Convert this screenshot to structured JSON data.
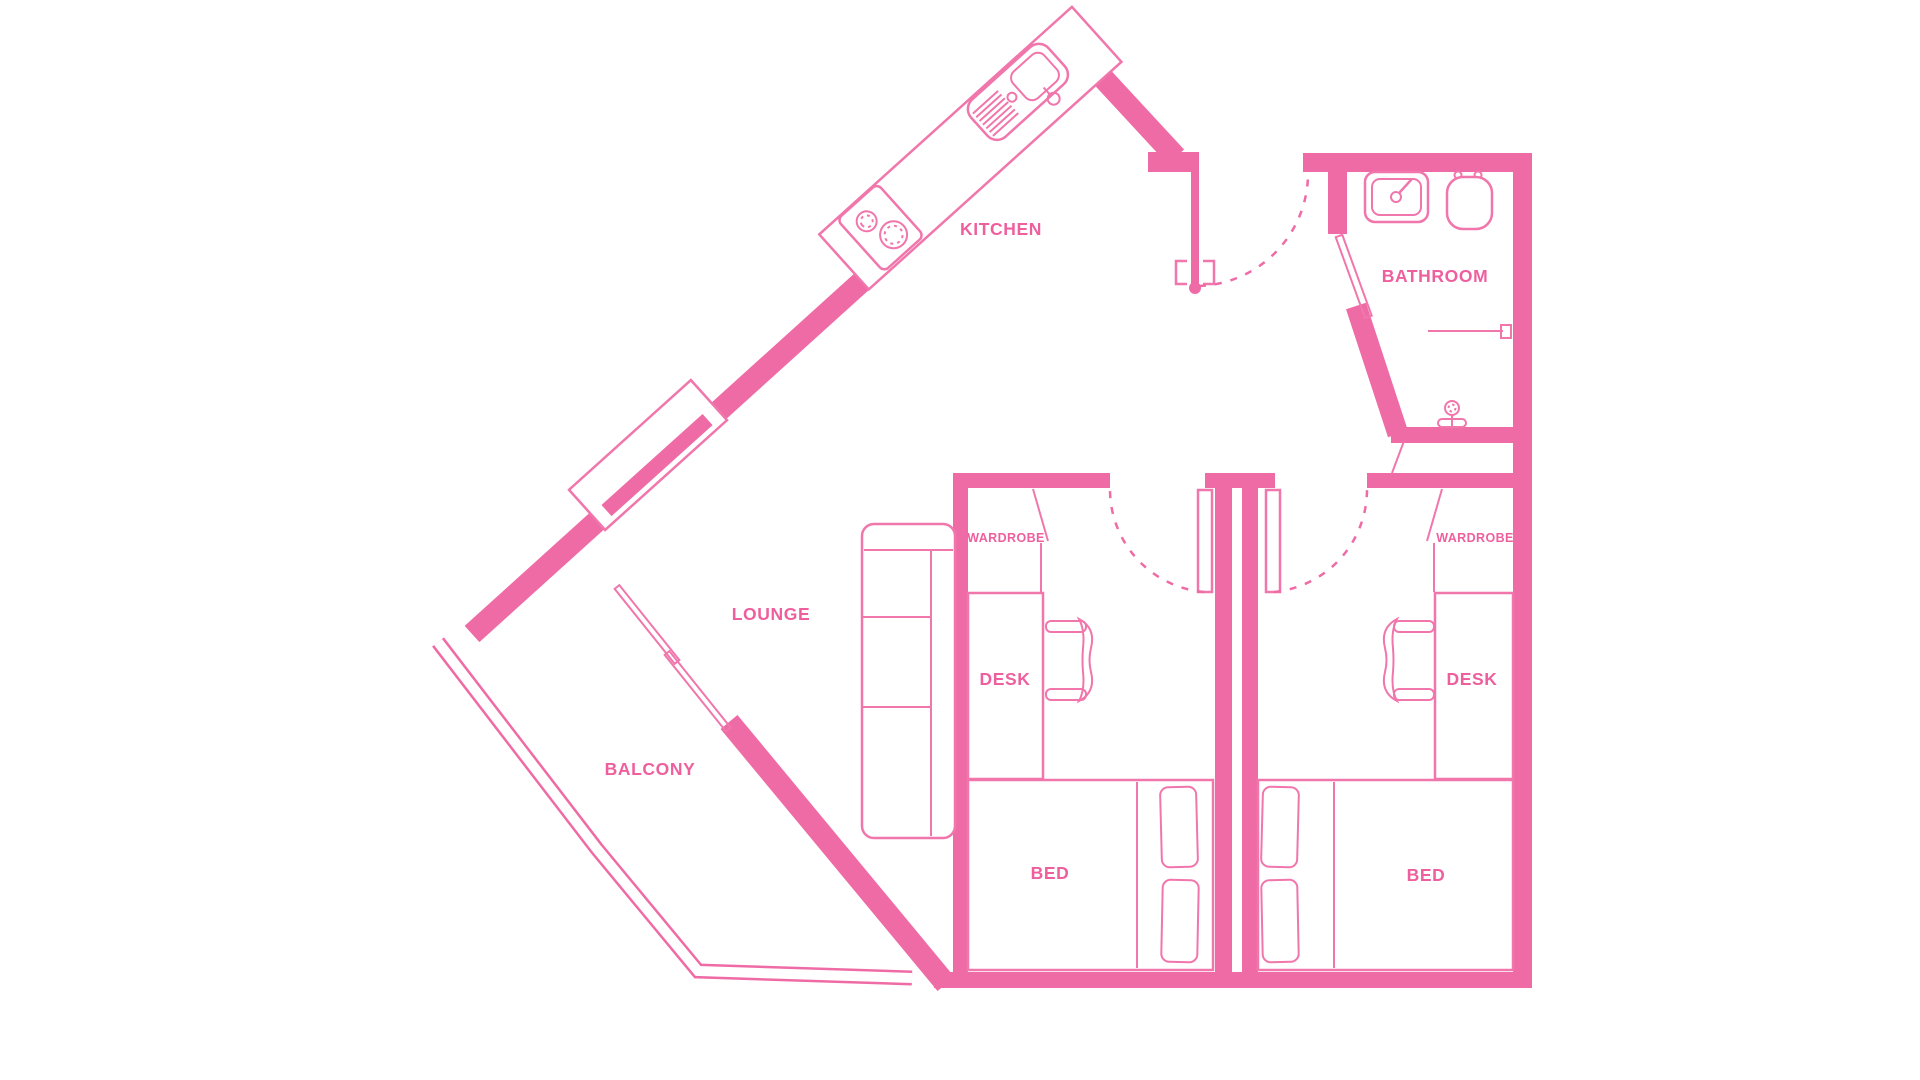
{
  "title": "Two-bedroom apartment floor plan",
  "colors": {
    "wall": "#ef6ba5",
    "fixture": "#f076ac",
    "label": "#ee5f9e",
    "background": "#ffffff"
  },
  "rooms": {
    "kitchen": {
      "label": "KITCHEN"
    },
    "bathroom": {
      "label": "BATHROOM"
    },
    "lounge": {
      "label": "LOUNGE"
    },
    "balcony": {
      "label": "BALCONY"
    },
    "bedroom_left": {
      "wardrobe_label": "WARDROBE",
      "desk_label": "DESK",
      "bed_label": "BED"
    },
    "bedroom_right": {
      "wardrobe_label": "WARDROBE",
      "desk_label": "DESK",
      "bed_label": "BED"
    }
  }
}
